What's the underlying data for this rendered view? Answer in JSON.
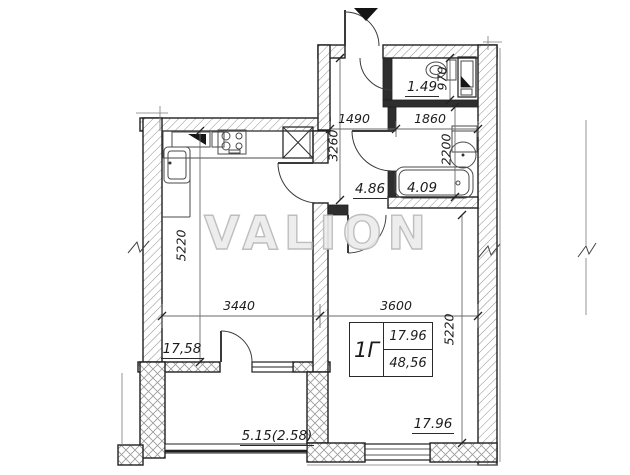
{
  "watermark": "VALION",
  "unit": {
    "name": "1Г",
    "living_area": "17.96",
    "total_area": "48,56"
  },
  "areas": {
    "wc": "1.49",
    "hallway": "4.86",
    "bathroom": "4.09",
    "kitchen_living": "17,58",
    "bedroom": "17.96",
    "balcony": "5.15(2.58)"
  },
  "dimensions_mm": {
    "hallway_width": "1490",
    "bathroom_width": "1860",
    "hallway_depth": "3260",
    "wc_depth": "970",
    "bathroom_depth": "2200",
    "kitchen_width": "3440",
    "bedroom_width": "3600",
    "kitchen_depth": "5220",
    "bedroom_depth": "5220"
  },
  "colors": {
    "background": "#ffffff",
    "wall_line": "#1f1f1f",
    "hatch": "#8f8f8f",
    "dim_line": "#666666",
    "watermark": "#d6d6d6"
  }
}
